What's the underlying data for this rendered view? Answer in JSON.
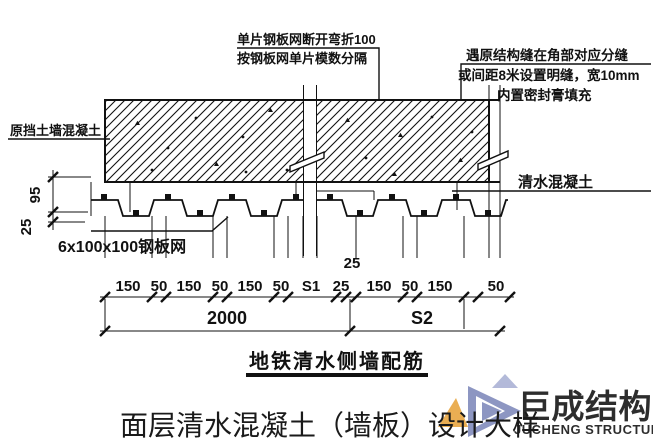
{
  "annotations": {
    "mesh_note_line1": "单片钢板网断开弯折100",
    "mesh_note_line2": "按钢板网单片模数分隔",
    "joint_note_line1": "遇原结构缝在角部对应分缝",
    "joint_note_line2": "或间距8米设置明缝，宽10mm",
    "joint_note_line3": "内置密封膏填充",
    "retaining_wall_label": "原挡土墙混凝土",
    "fair_faced_concrete_label": "清水混凝土",
    "steel_mesh_label": "6x100x100钢板网",
    "caption": "地铁清水侧墙配筋"
  },
  "dimensions": {
    "left_thickness": "95",
    "left_rib": "25",
    "row1": [
      "150",
      "50",
      "150",
      "50",
      "150",
      "50",
      "S1",
      "25",
      "150",
      "50",
      "150",
      "50"
    ],
    "raised": "25",
    "total_left": "2000",
    "total_right": "S2"
  },
  "title": "面层清水混凝土（墙板）设计大样",
  "logo": {
    "name": "巨成结构",
    "subtitle": "JUCHENG STRUCTURE",
    "orange": "#E8A33C",
    "blue": "#7E88BA",
    "subtitle_blue": "#3A4FA0"
  }
}
